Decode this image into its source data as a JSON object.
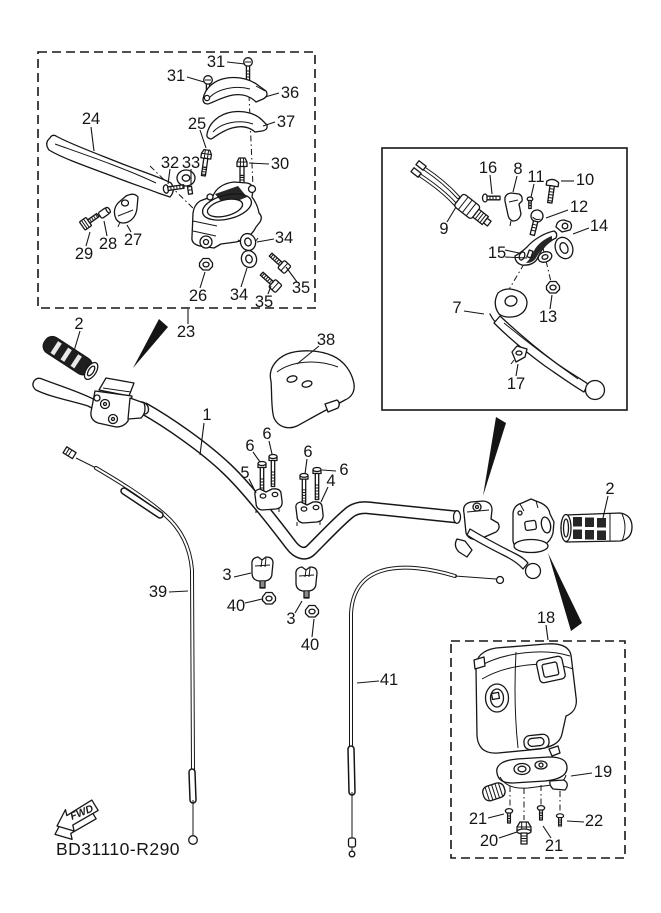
{
  "figure": {
    "code": "BD31110-R290",
    "fwd": "FWD"
  },
  "callouts": [
    {
      "label": "31",
      "x": 176,
      "y": 76,
      "leaders": [
        [
          187,
          77,
          204,
          82
        ]
      ]
    },
    {
      "label": "31",
      "x": 216,
      "y": 62,
      "leaders": [
        [
          227,
          62,
          245,
          64
        ]
      ]
    },
    {
      "label": "36",
      "x": 290,
      "y": 93,
      "leaders": [
        [
          279,
          93,
          265,
          97
        ]
      ]
    },
    {
      "label": "37",
      "x": 286,
      "y": 122,
      "leaders": [
        [
          275,
          122,
          263,
          126
        ]
      ]
    },
    {
      "label": "24",
      "x": 91,
      "y": 119,
      "leaders": [
        [
          91,
          127,
          94,
          151
        ]
      ]
    },
    {
      "label": "25",
      "x": 197,
      "y": 124,
      "leaders": [
        [
          200,
          130,
          206,
          148
        ]
      ]
    },
    {
      "label": "32",
      "x": 170,
      "y": 163,
      "leaders": [
        [
          170,
          169,
          168,
          184
        ]
      ]
    },
    {
      "label": "33",
      "x": 191,
      "y": 163,
      "leaders": [
        [
          191,
          169,
          191,
          185
        ]
      ]
    },
    {
      "label": "30",
      "x": 280,
      "y": 164,
      "leaders": [
        [
          269,
          164,
          249,
          163
        ]
      ]
    },
    {
      "label": "29",
      "x": 84,
      "y": 254,
      "leaders": [
        [
          86,
          246,
          90,
          232
        ]
      ]
    },
    {
      "label": "28",
      "x": 108,
      "y": 244,
      "leaders": [
        [
          107,
          236,
          104,
          221
        ]
      ]
    },
    {
      "label": "27",
      "x": 133,
      "y": 240,
      "leaders": [
        [
          131,
          232,
          127,
          225
        ]
      ]
    },
    {
      "label": "26",
      "x": 198,
      "y": 296,
      "leaders": [
        [
          200,
          288,
          205,
          272
        ]
      ]
    },
    {
      "label": "34",
      "x": 239,
      "y": 295,
      "leaders": [
        [
          241,
          287,
          247,
          268
        ]
      ]
    },
    {
      "label": "35",
      "x": 264,
      "y": 302,
      "leaders": [
        [
          268,
          294,
          271,
          286
        ]
      ]
    },
    {
      "label": "34",
      "x": 284,
      "y": 238,
      "leaders": [
        [
          274,
          239,
          257,
          242
        ]
      ]
    },
    {
      "label": "35",
      "x": 301,
      "y": 288,
      "leaders": [
        [
          297,
          282,
          286,
          267
        ]
      ]
    },
    {
      "label": "23",
      "x": 186,
      "y": 332,
      "leaders": [
        [
          188,
          324,
          188,
          309
        ]
      ]
    },
    {
      "label": "2",
      "x": 79,
      "y": 324,
      "leaders": [
        [
          80,
          331,
          74,
          351
        ]
      ]
    },
    {
      "label": "38",
      "x": 326,
      "y": 340,
      "leaders": [
        [
          319,
          346,
          297,
          364
        ]
      ]
    },
    {
      "label": "1",
      "x": 207,
      "y": 415,
      "leaders": [
        [
          204,
          423,
          200,
          455
        ]
      ]
    },
    {
      "label": "6",
      "x": 267,
      "y": 434,
      "leaders": [
        [
          269,
          441,
          272,
          454
        ]
      ]
    },
    {
      "label": "6",
      "x": 250,
      "y": 446,
      "leaders": [
        [
          253,
          452,
          260,
          462
        ]
      ]
    },
    {
      "label": "5",
      "x": 245,
      "y": 473,
      "leaders": [
        [
          249,
          479,
          256,
          493
        ]
      ]
    },
    {
      "label": "6",
      "x": 308,
      "y": 452,
      "leaders": [
        [
          307,
          459,
          305,
          474
        ]
      ]
    },
    {
      "label": "6",
      "x": 344,
      "y": 470,
      "leaders": [
        [
          336,
          471,
          322,
          470
        ]
      ]
    },
    {
      "label": "4",
      "x": 331,
      "y": 481,
      "leaders": [
        [
          328,
          487,
          321,
          502
        ]
      ]
    },
    {
      "label": "3",
      "x": 227,
      "y": 575,
      "leaders": [
        [
          234,
          577,
          251,
          573
        ]
      ]
    },
    {
      "label": "40",
      "x": 236,
      "y": 606,
      "leaders": [
        [
          245,
          603,
          262,
          599
        ]
      ]
    },
    {
      "label": "3",
      "x": 291,
      "y": 619,
      "leaders": [
        [
          295,
          613,
          302,
          601
        ]
      ]
    },
    {
      "label": "40",
      "x": 310,
      "y": 645,
      "leaders": [
        [
          312,
          637,
          314,
          619
        ]
      ]
    },
    {
      "label": "39",
      "x": 158,
      "y": 592,
      "leaders": [
        [
          169,
          592,
          188,
          591
        ]
      ]
    },
    {
      "label": "41",
      "x": 389,
      "y": 680,
      "leaders": [
        [
          379,
          681,
          357,
          683
        ]
      ]
    },
    {
      "label": "2",
      "x": 610,
      "y": 489,
      "leaders": [
        [
          608,
          496,
          603,
          518
        ]
      ]
    },
    {
      "label": "18",
      "x": 546,
      "y": 618,
      "leaders": [
        [
          546,
          625,
          548,
          640
        ]
      ]
    },
    {
      "label": "16",
      "x": 488,
      "y": 168,
      "leaders": [
        [
          490,
          175,
          492,
          194
        ]
      ]
    },
    {
      "label": "8",
      "x": 518,
      "y": 169,
      "leaders": [
        [
          517,
          176,
          513,
          192
        ]
      ]
    },
    {
      "label": "11",
      "x": 536,
      "y": 177,
      "leaders": [
        [
          534,
          184,
          531,
          197
        ]
      ]
    },
    {
      "label": "10",
      "x": 585,
      "y": 180,
      "leaders": [
        [
          574,
          181,
          561,
          181
        ]
      ]
    },
    {
      "label": "12",
      "x": 579,
      "y": 207,
      "leaders": [
        [
          568,
          210,
          546,
          218
        ]
      ]
    },
    {
      "label": "14",
      "x": 599,
      "y": 226,
      "leaders": [
        [
          589,
          228,
          573,
          234
        ]
      ]
    },
    {
      "label": "9",
      "x": 444,
      "y": 229,
      "leaders": [
        [
          447,
          222,
          456,
          207
        ]
      ]
    },
    {
      "label": "15",
      "x": 497,
      "y": 253,
      "leaders": [
        [
          505,
          250,
          519,
          253
        ],
        [
          505,
          257,
          527,
          258
        ]
      ]
    },
    {
      "label": "7",
      "x": 457,
      "y": 308,
      "leaders": [
        [
          464,
          311,
          484,
          314
        ]
      ]
    },
    {
      "label": "13",
      "x": 548,
      "y": 317,
      "leaders": [
        [
          550,
          309,
          552,
          295
        ]
      ]
    },
    {
      "label": "17",
      "x": 516,
      "y": 384,
      "leaders": [
        [
          516,
          376,
          518,
          364
        ]
      ]
    },
    {
      "label": "19",
      "x": 603,
      "y": 772,
      "leaders": [
        [
          592,
          773,
          571,
          776
        ]
      ]
    },
    {
      "label": "21",
      "x": 478,
      "y": 819,
      "leaders": [
        [
          488,
          818,
          504,
          814
        ]
      ]
    },
    {
      "label": "20",
      "x": 489,
      "y": 841,
      "leaders": [
        [
          499,
          838,
          517,
          832
        ]
      ]
    },
    {
      "label": "21",
      "x": 554,
      "y": 846,
      "leaders": [
        [
          551,
          838,
          543,
          826
        ]
      ]
    },
    {
      "label": "22",
      "x": 594,
      "y": 821,
      "leaders": [
        [
          584,
          822,
          567,
          821
        ]
      ]
    }
  ]
}
